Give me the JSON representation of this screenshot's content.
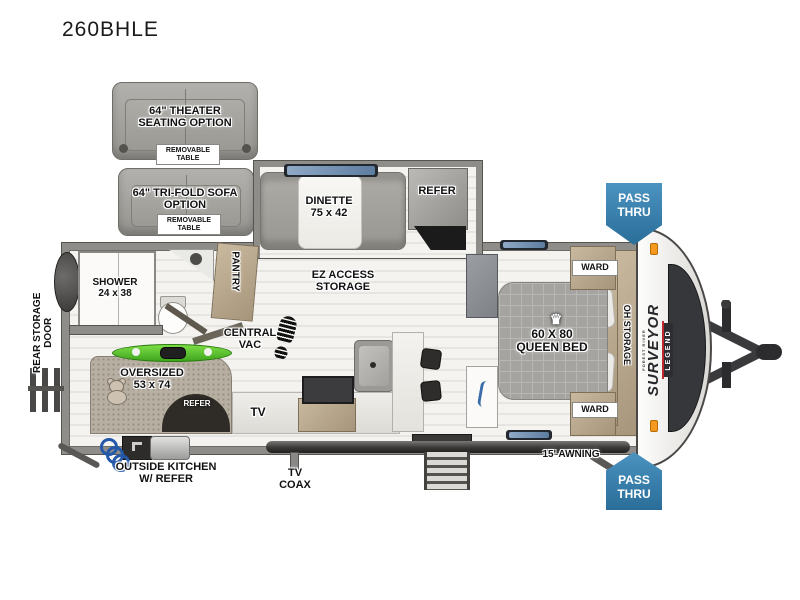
{
  "title": "260BHLE",
  "options": {
    "theater": {
      "label": "64\" THEATER\nSEATING OPTION",
      "table": "REMOVABLE\nTABLE"
    },
    "trifold": {
      "label": "64\" TRI-FOLD SOFA\nOPTION",
      "table": "REMOVABLE\nTABLE"
    }
  },
  "rooms": {
    "dinette": "DINETTE\n75 x 42",
    "ez_access_storage": "EZ ACCESS\nSTORAGE",
    "refer": "REFER",
    "shower": "SHOWER\n24 x 38",
    "pantry": "PANTRY",
    "central_vac": "CENTRAL\nVAC",
    "oversized_bunk": "OVERSIZED\n53 x 74",
    "bunk_refer": "REFER",
    "tv": "TV",
    "queen_bed": "60 X 80\nQUEEN BED",
    "ward_top": "WARD",
    "ward_bottom": "WARD",
    "oh_storage": "OH STORAGE",
    "rear_storage_door": "REAR STORAGE\nDOOR"
  },
  "exterior": {
    "outside_kitchen": "OUTSIDE KITCHEN\nW/ REFER",
    "tv_coax": "TV\nCOAX",
    "awning": "15' AWNING",
    "pass_thru_top": "PASS\nTHRU",
    "pass_thru_bottom": "PASS\nTHRU",
    "brand_maker": "FOREST RIVER",
    "brand_name": "SURVEYOR",
    "brand_series": "LEGEND",
    "crown_icon": "♛"
  },
  "colors": {
    "pass_thru_blue": "#2e7dab",
    "kayak_green": "#55c42d",
    "wood_tan": "#b9a98f",
    "accent_red": "#c0272d"
  }
}
